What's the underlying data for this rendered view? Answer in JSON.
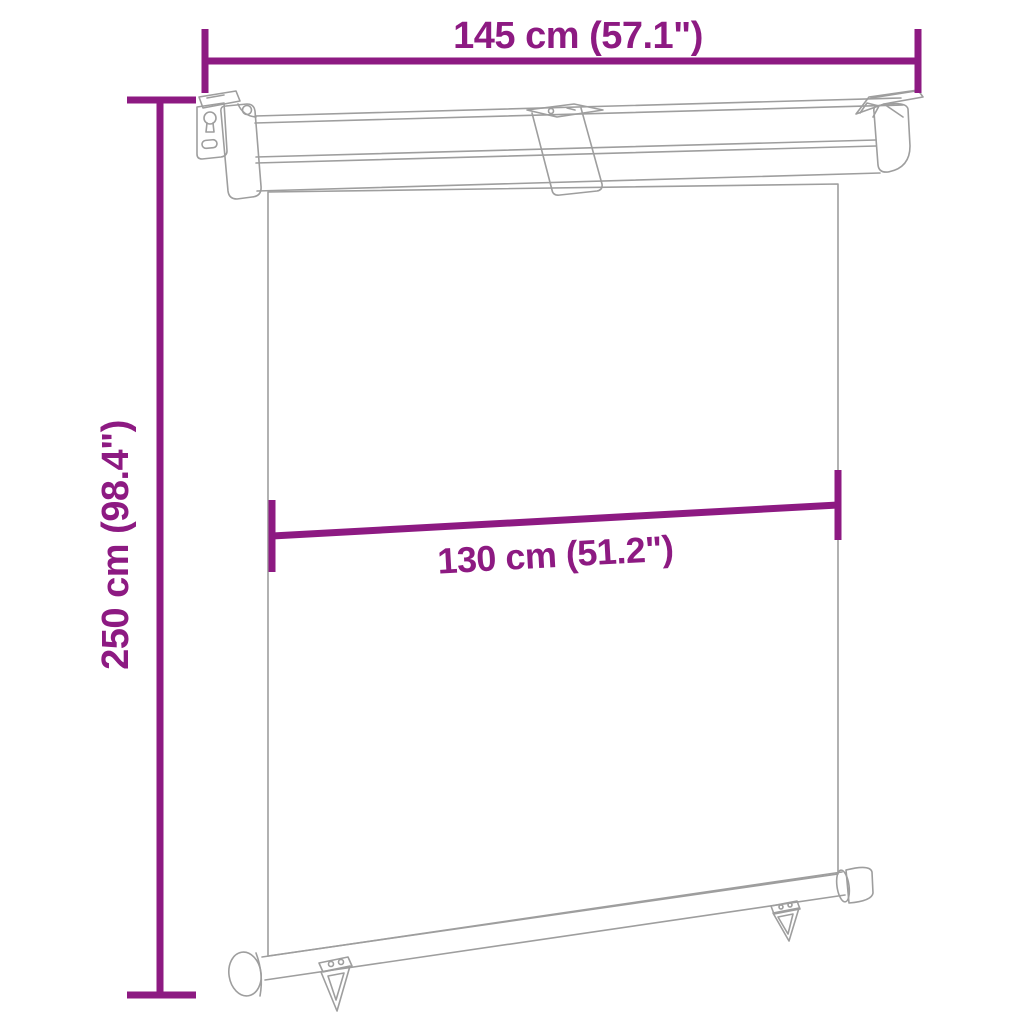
{
  "title": "Side awning dimension diagram",
  "colors": {
    "dimension": "#8d1a82",
    "line_art": "#9e9e9e",
    "background": "#ffffff"
  },
  "dimensions": {
    "top_width": {
      "label": "145 cm (57.1\")"
    },
    "left_height": {
      "label": "250 cm (98.4\")"
    },
    "inner_width": {
      "label": "130 cm (51.2\")"
    }
  },
  "figure": {
    "type": "line-drawing",
    "subject": "vertical balcony side awning: wall-mount cassette rail with brackets, retractable fabric panel, bottom pole with end caps and two triangular pull hooks"
  }
}
